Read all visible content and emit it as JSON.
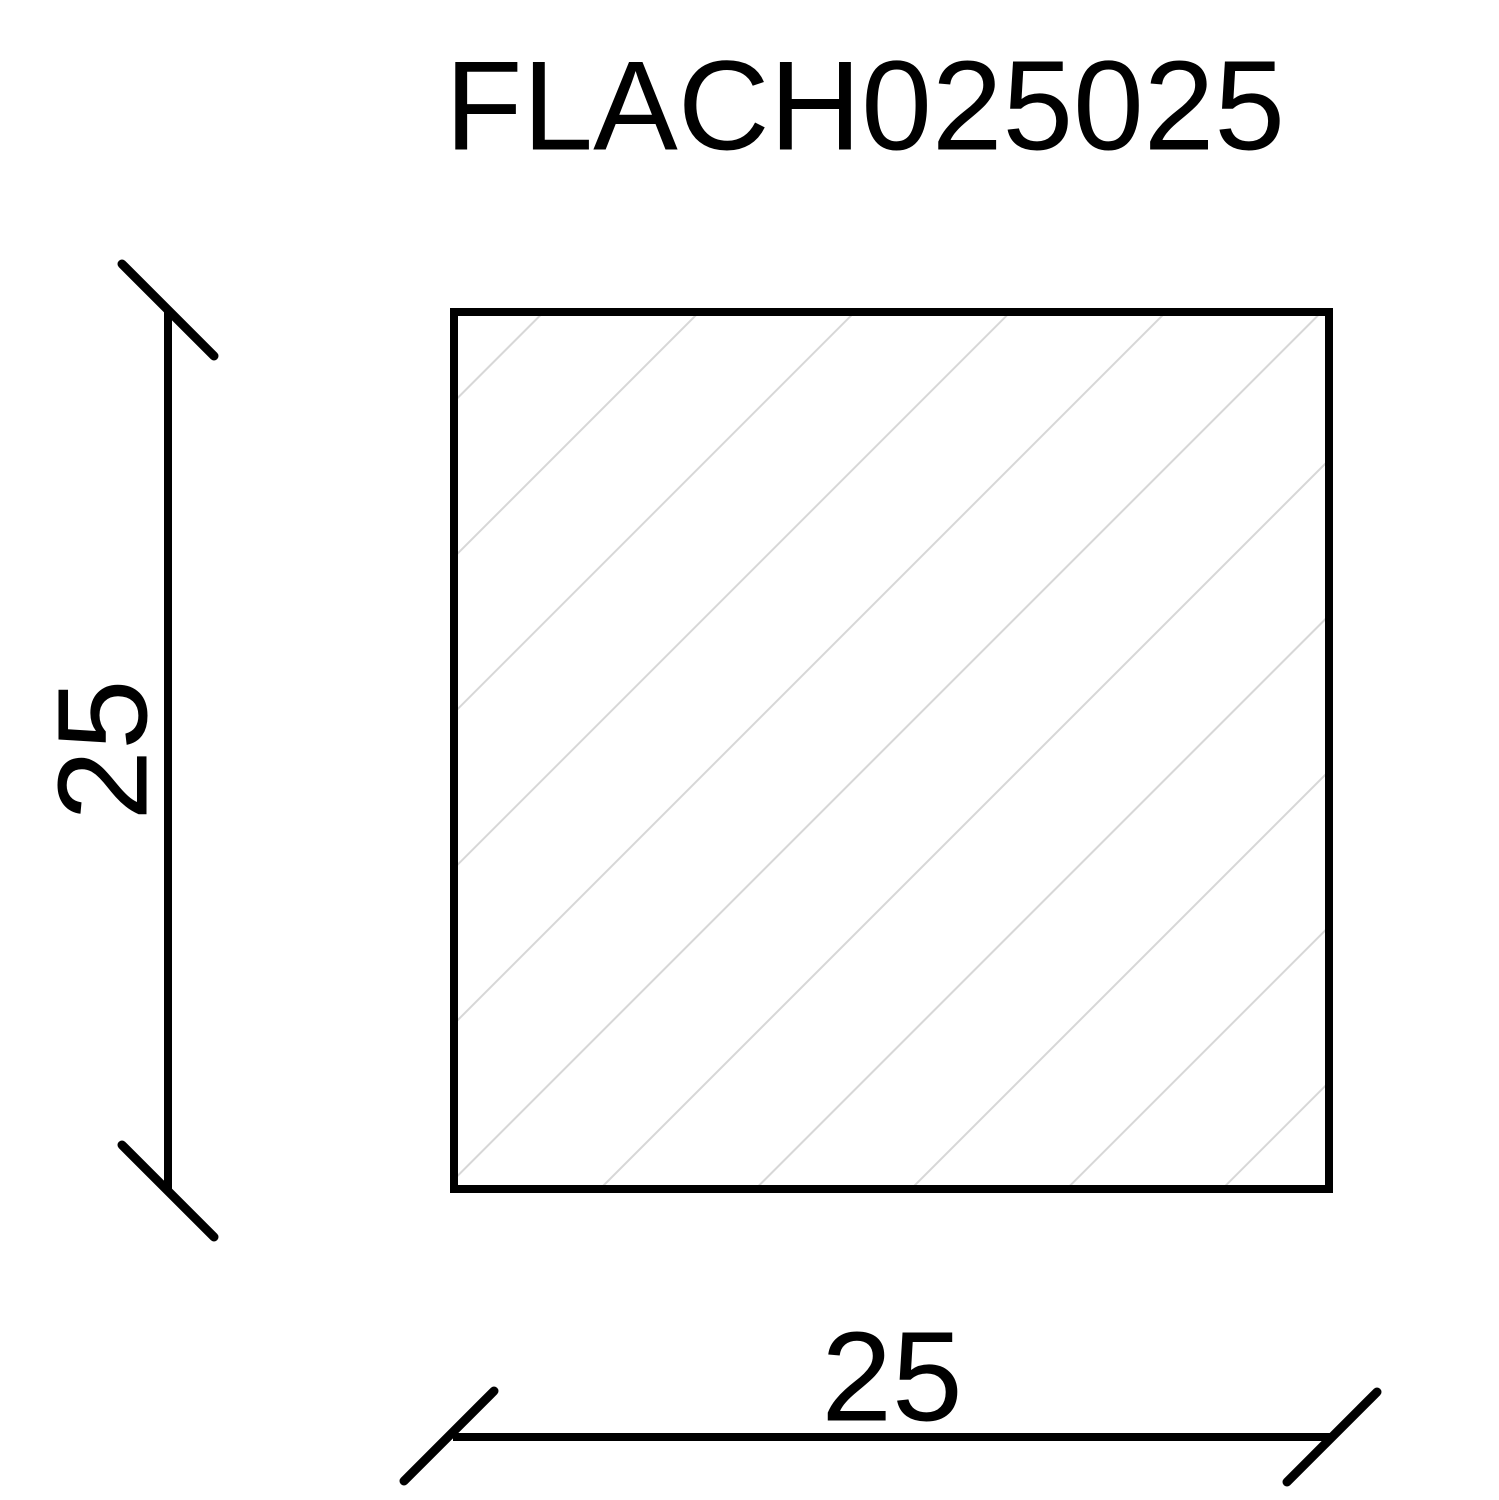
{
  "title": "FLACH025025",
  "dimensions": {
    "height": {
      "label": "25"
    },
    "width": {
      "label": "25"
    }
  },
  "colors": {
    "stroke": "#000000",
    "hatch": "#d7d7d7",
    "background": "#ffffff"
  }
}
